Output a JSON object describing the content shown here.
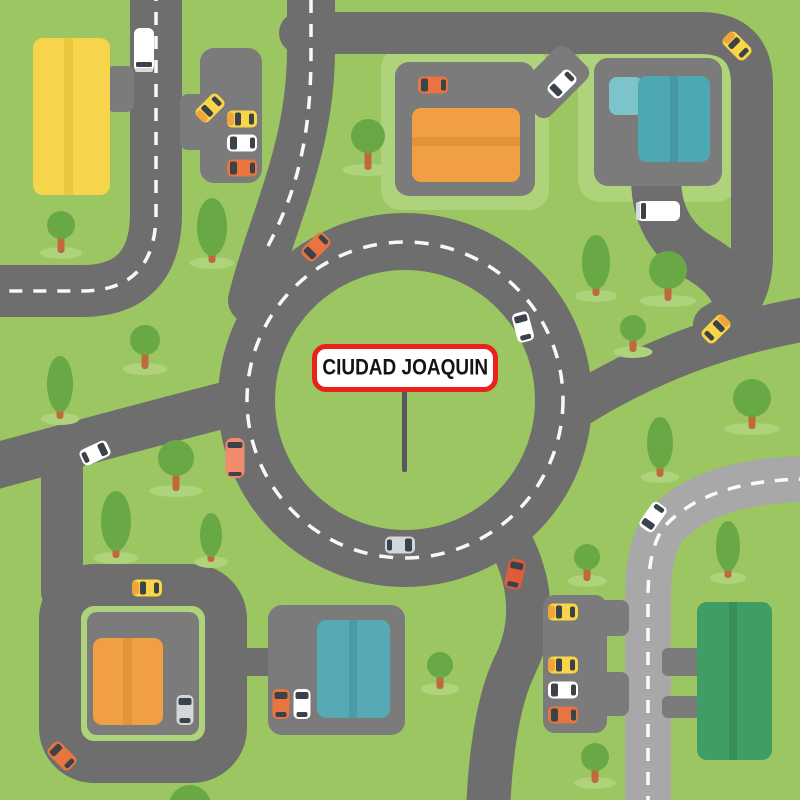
{
  "sign": {
    "text": "CIUDAD JOAQUIN"
  },
  "palette": {
    "grass": "#9bc661",
    "grass_light": "#aed37b",
    "road": "#6e6e6e",
    "road_light": "#a8a8a8",
    "plaza": "#7b7b7b",
    "dash": "#ffffff",
    "tree_crown": "#68a946",
    "tree_trunk": "#c0693c",
    "sign_border": "#e8221c",
    "sign_bg": "#ffffff",
    "sign_text": "#141414",
    "sign_pole": "#55585c",
    "taxi_yellow": "#f9d648",
    "taxi_hood": "#f0a43c",
    "car_orange": "#e8743f",
    "car_red": "#df5b3c",
    "car_white": "#ffffff",
    "car_silver": "#d2d7da",
    "van_salmon": "#f28a6d",
    "window_dark": "#3c4249",
    "truck_bumper": "#d6dadd"
  },
  "map": {
    "lawns": [
      {
        "name": "plaza-north-lawn",
        "x": 381,
        "y": 48,
        "w": 168,
        "h": 162,
        "rx": 20
      },
      {
        "name": "plaza-ne-lawn",
        "x": 578,
        "y": 42,
        "w": 160,
        "h": 160,
        "rx": 22
      }
    ],
    "loop_lawn": {
      "name": "loop-lawn",
      "x": 81,
      "y": 606,
      "w": 124,
      "h": 135,
      "rx": 14
    },
    "roads": {
      "dark": [
        {
          "name": "west-vertical-road",
          "d": "M 156 -12 L 156 213 Q 156 291 82 291 L -12 291",
          "w": 52
        },
        {
          "name": "north-road-a",
          "d": "M 311 -12 L 311 50 C 311 150 272 220 252 300",
          "w": 48
        },
        {
          "name": "north-road-b",
          "d": "M 300 33 L 700 33",
          "w": 42
        },
        {
          "name": "northeast-vertical-road",
          "d": "M 700 33 Q 752 33 752 85 L 752 255 Q 752 305 714 325",
          "w": 42
        },
        {
          "name": "northeast-diagonal-road",
          "d": "M 572 409 Q 680 340 812 318",
          "w": 44
        },
        {
          "name": "southeast-exit-road",
          "d": "M 514 549 Q 542 610 515 665 Q 492 712 488 812",
          "w": 44
        },
        {
          "name": "southwest-diagonal-road",
          "d": "M -12 468 Q 120 432 248 399",
          "w": 46
        },
        {
          "name": "loop-connector-road",
          "d": "M 62 452 L 62 592",
          "w": 42
        },
        {
          "name": "plaza-ne-junction-driveway",
          "d": "M 656 178 Q 656 232 700 258 Q 728 274 738 298",
          "w": 50
        }
      ],
      "loop": {
        "x": 60,
        "y": 585,
        "w": 166,
        "h": 177,
        "rx": 34,
        "sw": 42
      },
      "light": [
        {
          "name": "east-light-road",
          "d": "M 812 479 Q 707 479 664 527 Q 648 548 648 598 L 648 812",
          "w": 46
        }
      ],
      "dashes": [
        {
          "name": "west-road-dashes",
          "d": "M 156 -12 L 156 213 Q 156 291 82 291 L -12 291"
        },
        {
          "name": "north-road-dashes",
          "d": "M 311 0 L 311 52 C 311 150 292 200 266 250"
        },
        {
          "name": "east-road-dashes",
          "d": "M 812 479 Q 707 479 664 527 Q 648 548 648 598 L 648 812"
        }
      ],
      "roundabout": {
        "cx": 405,
        "cy": 400,
        "outer_r": 187,
        "inner_r": 130,
        "dash_r": 158
      }
    },
    "plazas": [
      {
        "name": "parking-nw",
        "x": 200,
        "y": 48,
        "w": 62,
        "h": 135,
        "rx": 14
      },
      {
        "name": "parking-nw-entry",
        "x": 180,
        "y": 94,
        "w": 30,
        "h": 56,
        "rx": 8
      },
      {
        "name": "yellow-building-driveway",
        "x": 106,
        "y": 66,
        "w": 28,
        "h": 46,
        "rx": 8
      },
      {
        "name": "plaza-north",
        "x": 395,
        "y": 62,
        "w": 140,
        "h": 134,
        "rx": 14
      },
      {
        "name": "plaza-north-driveway",
        "x": -22,
        "y": -35,
        "w": 44,
        "h": 70,
        "rx": 10,
        "rotate": 45,
        "tx": 553,
        "ty": 82
      },
      {
        "name": "plaza-ne",
        "x": 594,
        "y": 58,
        "w": 128,
        "h": 128,
        "rx": 14
      },
      {
        "name": "plaza-sw",
        "x": 87,
        "y": 612,
        "w": 112,
        "h": 123,
        "rx": 10
      },
      {
        "name": "loop-plaza-stub",
        "x": 220,
        "y": 648,
        "w": 56,
        "h": 28,
        "rx": 0,
        "color": "road"
      },
      {
        "name": "plaza-south",
        "x": 268,
        "y": 605,
        "w": 137,
        "h": 130,
        "rx": 14
      },
      {
        "name": "parking-se",
        "x": 543,
        "y": 595,
        "w": 64,
        "h": 138,
        "rx": 12
      },
      {
        "name": "parking-se-stub-1",
        "x": 595,
        "y": 600,
        "w": 34,
        "h": 36,
        "rx": 8
      },
      {
        "name": "parking-se-stub-2",
        "x": 595,
        "y": 672,
        "w": 34,
        "h": 44,
        "rx": 8
      },
      {
        "name": "green-building-driveway-1",
        "x": 662,
        "y": 648,
        "w": 40,
        "h": 28,
        "rx": 6
      },
      {
        "name": "green-building-driveway-2",
        "x": 662,
        "y": 696,
        "w": 40,
        "h": 22,
        "rx": 6
      }
    ],
    "buildings": [
      {
        "name": "yellow-building",
        "x": 33,
        "y": 38,
        "w": 77,
        "h": 157,
        "rx": 10,
        "color": "#f6d44c",
        "stripes": [
          {
            "x": 64,
            "y": 38,
            "w": 9,
            "h": 157,
            "color": "#e9c83e"
          }
        ]
      },
      {
        "name": "orange-building-north",
        "x": 412,
        "y": 108,
        "w": 108,
        "h": 74,
        "rx": 9,
        "color": "#f0a042",
        "stripes": [
          {
            "x": 412,
            "y": 137,
            "w": 108,
            "h": 9,
            "color": "#e2943a"
          }
        ]
      },
      {
        "name": "teal-building-ne",
        "x": 638,
        "y": 76,
        "w": 72,
        "h": 86,
        "rx": 9,
        "color": "#4ea8b3",
        "stripes": [
          {
            "x": 670,
            "y": 76,
            "w": 8,
            "h": 86,
            "color": "#4597a4"
          }
        ],
        "annex": {
          "x": 609,
          "y": 77,
          "w": 34,
          "h": 38,
          "rx": 8,
          "color": "#7cc4ca"
        }
      },
      {
        "name": "orange-building-sw",
        "x": 93,
        "y": 638,
        "w": 70,
        "h": 87,
        "rx": 9,
        "color": "#f0a042",
        "stripes": [
          {
            "x": 123,
            "y": 638,
            "w": 9,
            "h": 87,
            "color": "#e2943a"
          }
        ]
      },
      {
        "name": "teal-building-south",
        "x": 317,
        "y": 620,
        "w": 73,
        "h": 98,
        "rx": 9,
        "color": "#56aab5",
        "stripes": [
          {
            "x": 349,
            "y": 620,
            "w": 8,
            "h": 98,
            "color": "#4b9aa6"
          }
        ]
      },
      {
        "name": "green-building-se",
        "x": 697,
        "y": 602,
        "w": 75,
        "h": 158,
        "rx": 10,
        "color": "#3f9e64",
        "stripes": [
          {
            "x": 729,
            "y": 602,
            "w": 8,
            "h": 158,
            "color": "#389058"
          }
        ]
      }
    ],
    "sign_pole": {
      "x": 402,
      "y": 390,
      "w": 5,
      "h": 82
    },
    "trees": [
      {
        "t": "r",
        "x": 61,
        "cy": 225,
        "r": 14,
        "sy": 253
      },
      {
        "t": "o",
        "x": 212,
        "cy": 227,
        "rx": 15,
        "ry": 29,
        "sy": 263
      },
      {
        "t": "r",
        "x": 368,
        "cy": 136,
        "r": 17,
        "sy": 170
      },
      {
        "t": "o",
        "x": 60,
        "cy": 384,
        "rx": 13,
        "ry": 28,
        "sy": 419
      },
      {
        "t": "r",
        "x": 145,
        "cy": 340,
        "r": 15,
        "sy": 369
      },
      {
        "t": "r",
        "x": 176,
        "cy": 458,
        "r": 18,
        "sy": 491
      },
      {
        "t": "o",
        "x": 116,
        "cy": 521,
        "rx": 15,
        "ry": 30,
        "sy": 558
      },
      {
        "t": "o",
        "x": 211,
        "cy": 535,
        "rx": 11,
        "ry": 22,
        "sy": 562
      },
      {
        "t": "o",
        "x": 596,
        "cy": 262,
        "rx": 14,
        "ry": 27,
        "sy": 296
      },
      {
        "t": "r",
        "x": 668,
        "cy": 270,
        "r": 19,
        "sy": 301
      },
      {
        "t": "r",
        "x": 633,
        "cy": 328,
        "r": 13,
        "sy": 352
      },
      {
        "t": "r",
        "x": 752,
        "cy": 398,
        "r": 19,
        "sy": 429
      },
      {
        "t": "o",
        "x": 660,
        "cy": 443,
        "rx": 13,
        "ry": 26,
        "sy": 477
      },
      {
        "t": "o",
        "x": 728,
        "cy": 546,
        "rx": 12,
        "ry": 25,
        "sy": 578
      },
      {
        "t": "r",
        "x": 587,
        "cy": 557,
        "r": 13,
        "sy": 581
      },
      {
        "t": "r",
        "x": 440,
        "cy": 665,
        "r": 13,
        "sy": 689
      },
      {
        "t": "r",
        "x": 595,
        "cy": 757,
        "r": 14,
        "sy": 783
      },
      {
        "t": "r",
        "x": 190,
        "cy": 806,
        "r": 21,
        "sy": 0
      }
    ],
    "cars": [
      {
        "t": "truck",
        "x": 144,
        "y": 50,
        "r": 180,
        "c": "#ffffff"
      },
      {
        "t": "taxi",
        "x": 210,
        "y": 108,
        "r": 225
      },
      {
        "t": "taxi",
        "x": 242,
        "y": 119,
        "r": 270
      },
      {
        "t": "car",
        "x": 242,
        "y": 143,
        "r": 270,
        "c": "#ffffff"
      },
      {
        "t": "car",
        "x": 242,
        "y": 168,
        "r": 270,
        "c": "#e8743f"
      },
      {
        "t": "car",
        "x": 433,
        "y": 85,
        "r": 270,
        "c": "#e8743f"
      },
      {
        "t": "car",
        "x": 562,
        "y": 84,
        "r": 225,
        "c": "#ffffff"
      },
      {
        "t": "taxi",
        "x": 737,
        "y": 46,
        "r": 315
      },
      {
        "t": "car",
        "x": 316,
        "y": 247,
        "r": 225,
        "c": "#e8743f"
      },
      {
        "t": "car",
        "x": 523,
        "y": 327,
        "r": -15,
        "c": "#ffffff"
      },
      {
        "t": "taxi",
        "x": 716,
        "y": 329,
        "r": 45
      },
      {
        "t": "van",
        "x": 235,
        "y": 458,
        "r": 0,
        "c": "#f28a6d"
      },
      {
        "t": "car",
        "x": 95,
        "y": 453,
        "r": 65,
        "c": "#ffffff"
      },
      {
        "t": "car",
        "x": 400,
        "y": 545,
        "r": 90,
        "c": "#d2d7da"
      },
      {
        "t": "car",
        "x": 515,
        "y": 574,
        "r": 12,
        "c": "#df5b3c"
      },
      {
        "t": "car",
        "x": 653,
        "y": 517,
        "r": 215,
        "c": "#ffffff"
      },
      {
        "t": "truck",
        "x": 658,
        "y": 211,
        "r": 270,
        "c": "#ffffff"
      },
      {
        "t": "taxi",
        "x": 563,
        "y": 612,
        "r": 270
      },
      {
        "t": "taxi",
        "x": 563,
        "y": 665,
        "r": 270
      },
      {
        "t": "car",
        "x": 563,
        "y": 690,
        "r": 270,
        "c": "#ffffff"
      },
      {
        "t": "car",
        "x": 563,
        "y": 715,
        "r": 270,
        "c": "#e8743f"
      },
      {
        "t": "taxi",
        "x": 147,
        "y": 588,
        "r": 270
      },
      {
        "t": "car",
        "x": 185,
        "y": 710,
        "r": 0,
        "c": "#d2d7da"
      },
      {
        "t": "car",
        "x": 62,
        "y": 756,
        "r": 315,
        "c": "#e8743f"
      },
      {
        "t": "car",
        "x": 281,
        "y": 704,
        "r": 0,
        "c": "#e8743f"
      },
      {
        "t": "car",
        "x": 302,
        "y": 704,
        "r": 0,
        "c": "#ffffff"
      }
    ]
  }
}
